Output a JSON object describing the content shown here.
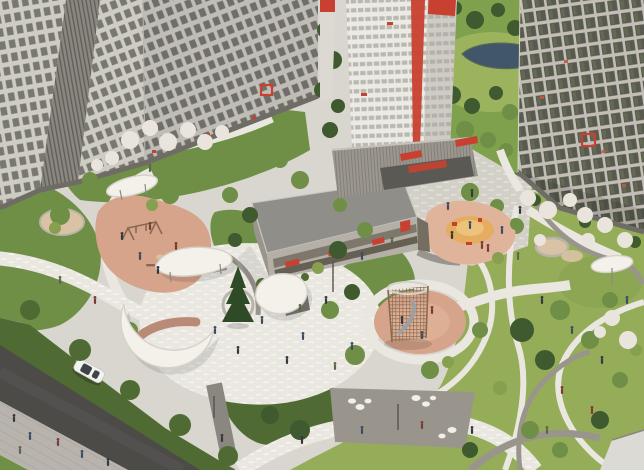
{
  "scene": {
    "title": "Aerial 3D visualization of a residential complex courtyard",
    "description": "Bird's-eye architectural render: white tower with red stripe, beige apartment slabs, glass-grid tower, two-storey parking garage with red accents, landscaped courtyard with organic white canopies, pink rubber playgrounds, climbing tower with slide, winding paths, lawns, blossoming trees, a pond in the back park, and an asphalt street with one white car and pedestrians",
    "time_of_day": "day"
  },
  "palette": {
    "paving_light": "#d8d6cf",
    "paving_white": "#e9e7e0",
    "granite": "#d3d0c8",
    "path_gray": "#99958d",
    "path_dark": "#8a8680",
    "asphalt": "#4d4b48",
    "road_wear": "#5a5855",
    "sidewalk": "#b8b4ad",
    "curb": "#8a8781",
    "lawn": "#95ad59",
    "green_mid": "#6f8f47",
    "green_dark": "#4f6b33",
    "shrub_dark": "#3f5a2e",
    "tree_light": "#86a050",
    "blossom_white": "#e9e5dc",
    "spruce": "#2f4a26",
    "water": "#42566b",
    "water_edge": "#5a6a50",
    "park_green": "#7fa04d",
    "park_grass": "#9cb35e",
    "pg_pink": "#d6a38b",
    "pg_pink_light": "#e0b49a",
    "pg_orange": "#e5ad5f",
    "pg_orange_light": "#edc27b",
    "pg_tan": "#d9c3a4",
    "equipment_red": "#c2422e",
    "canopy_white": "#f3f1ea",
    "canopy_edge": "#d5d2c9",
    "pavilion_gray": "#8d8a83",
    "pavilion_dark": "#6f6c66",
    "pavilion_terracotta": "#b98a77",
    "bldg_light": "#cfccc4",
    "bldg_white": "#eceae4",
    "bldg_side": "#dcd9d2",
    "bldg_right": "#c3bfb6",
    "bldg_mesh": "#8a8780",
    "mesh_dark": "#5f5d57",
    "tower_band": "#b5b3ac",
    "window_dark": "#63625b",
    "window_glass": "#4f5148",
    "window_reflect": "#707a55",
    "red_dot": "#bf5a40",
    "accent_red": "#c8402f",
    "garage_roof": "#908e89",
    "garage_wall": "#b4afa7",
    "garage_band": "#746e62",
    "garage_band2": "#655f54",
    "podium": "#9b978f",
    "fence_line": "#76736c",
    "ground_floor": "#5b5954",
    "base_strip": "#6f6c65",
    "rock_white": "#f1efe9",
    "dash_white": "#ffffff",
    "side_line": "#a6a29b",
    "lattice_brown": "#8a6a4f",
    "slide_gray": "#9aa0a3",
    "planter_ring": "#b9b4ab",
    "corner_roof": "#dcdad4",
    "car_white": "#f2f2f0",
    "car_glass": "#3e4347",
    "pole": "#55524d",
    "person_navy": "#3c4c62",
    "person_dark": "#35383f",
    "person_maroon": "#7c3a34",
    "person_olive": "#5d6648"
  },
  "objects": {
    "buildings": [
      {
        "name": "left-apartment-slab",
        "style": "beige facade, dense window grid"
      },
      {
        "name": "top-apartment-slab",
        "style": "beige facade, red-outlined highlighted window"
      },
      {
        "name": "central-tower",
        "style": "white tower, red vertical stripe and red crown panel, podium with red awnings"
      },
      {
        "name": "right-tower",
        "style": "glass grid facade, red-outlined highlighted window"
      },
      {
        "name": "parking-garage",
        "style": "two-storey, grey walls, window bands, red accent panels"
      }
    ],
    "site_features": [
      {
        "name": "crescent-canopy-pavilion"
      },
      {
        "name": "leaf-canopy-pavilion"
      },
      {
        "name": "round-canopy-kiosk"
      },
      {
        "name": "small-canopy"
      },
      {
        "name": "umbrella-canopy"
      },
      {
        "name": "swing-playground",
        "surface": "pink rubber"
      },
      {
        "name": "toddler-playground",
        "surface": "orange mound on pink rubber"
      },
      {
        "name": "climbing-tower-playground",
        "equipment": "timber lattice tower with slide"
      },
      {
        "name": "sand-circle"
      },
      {
        "name": "boulder-cluster",
        "color": "white"
      },
      {
        "name": "round-bench"
      },
      {
        "name": "spruce-tree-in-planter"
      },
      {
        "name": "pond"
      }
    ],
    "vehicles": [
      {
        "name": "car",
        "color": "white"
      }
    ],
    "highlighted_window_markers": 2,
    "people": "many tiny pedestrian figures on plazas, paths and sidewalk"
  }
}
